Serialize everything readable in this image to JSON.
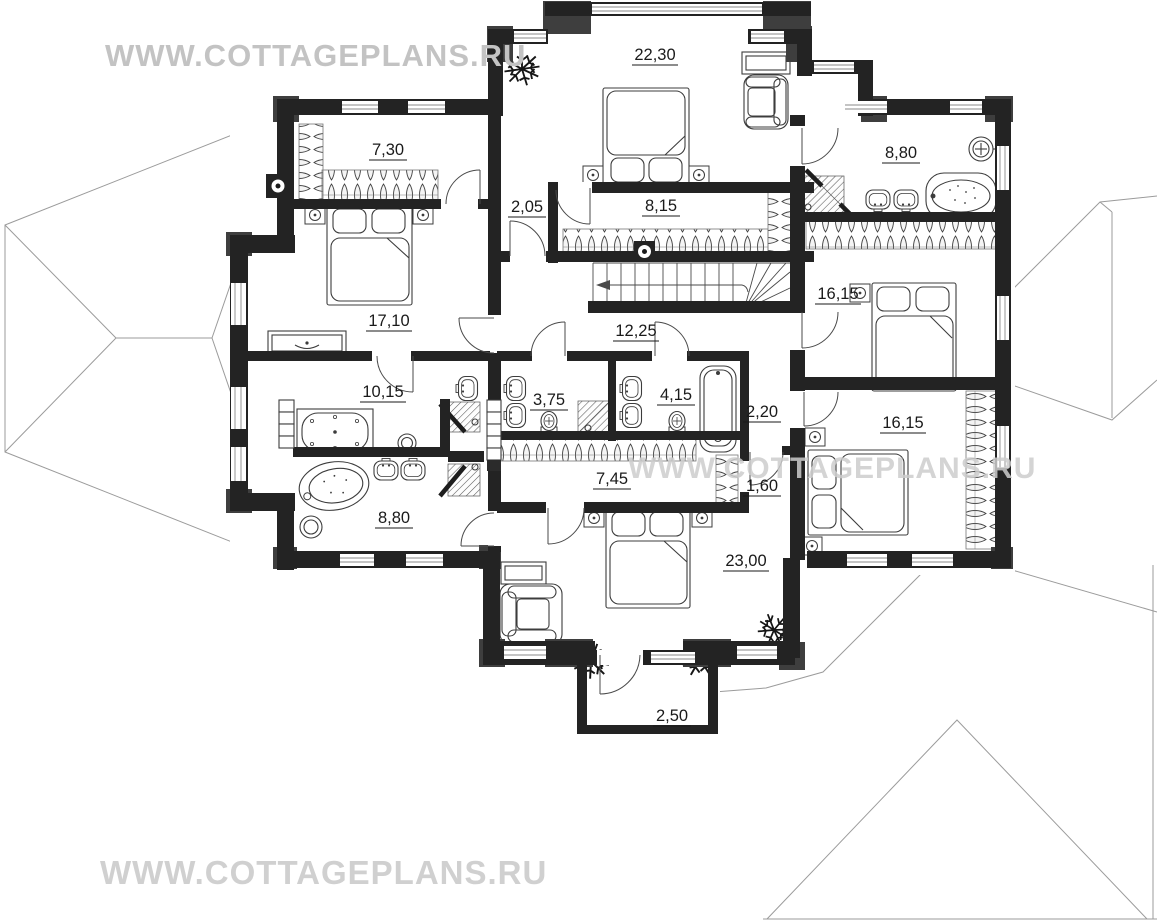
{
  "watermark": {
    "text": "WWW.COTTAGEPLANS.RU"
  },
  "floor_plan": {
    "type": "second-floor cottage plan",
    "rooms": [
      {
        "name": "bedroom-top",
        "area": "22,30"
      },
      {
        "name": "wardrobe-top-left",
        "area": "7,30"
      },
      {
        "name": "bathroom-top-right",
        "area": "8,80"
      },
      {
        "name": "vestibule",
        "area": "2,05"
      },
      {
        "name": "wardrobe-center",
        "area": "8,15"
      },
      {
        "name": "bedroom-left",
        "area": "17,10"
      },
      {
        "name": "bedroom-right-upper",
        "area": "16,15"
      },
      {
        "name": "hall",
        "area": "12,25"
      },
      {
        "name": "bathroom-left-upper",
        "area": "10,15"
      },
      {
        "name": "bathroom-center-left",
        "area": "3,75"
      },
      {
        "name": "bathroom-center-right",
        "area": "4,15"
      },
      {
        "name": "corridor-upper",
        "area": "2,20"
      },
      {
        "name": "bedroom-right-lower",
        "area": "16,15"
      },
      {
        "name": "wardrobe-bottom",
        "area": "7,45"
      },
      {
        "name": "corridor-lower",
        "area": "1,60"
      },
      {
        "name": "bathroom-left-lower",
        "area": "8,80"
      },
      {
        "name": "bedroom-bottom",
        "area": "23,00"
      },
      {
        "name": "balcony",
        "area": "2,50"
      }
    ],
    "colors": {
      "wall": "#232323",
      "quoin": "#3e3e3e",
      "roof_line": "#9b9b9b",
      "watermark": "#c9c9c9"
    }
  }
}
